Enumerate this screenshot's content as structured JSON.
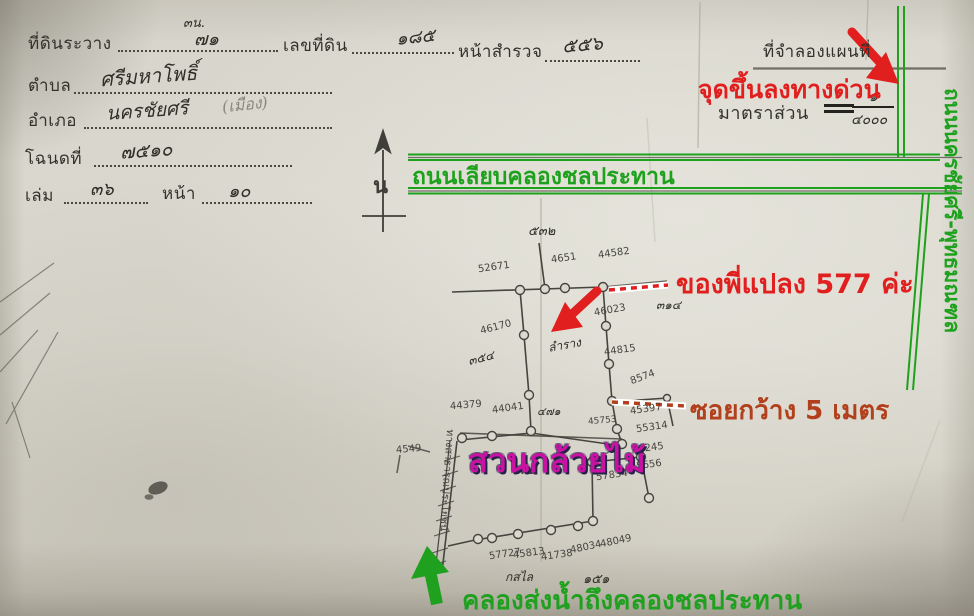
{
  "document": {
    "corner_note": "๓น.",
    "fields": {
      "sheet": {
        "label": "ที่ดินระวาง",
        "value": "๗๑"
      },
      "land_no": {
        "label": "เลขที่ดิน",
        "value": "๑๘๕"
      },
      "survey": {
        "label": "หน้าสำรวจ",
        "value": "๕๕๖"
      },
      "tambon": {
        "label": "ตำบล",
        "value": "ศรีมหาโพธิ์"
      },
      "amphoe": {
        "label": "อำเภอ",
        "value": "นครชัยศรี",
        "note": "(เมือง)"
      },
      "deed": {
        "label": "โฉนดที่",
        "value": "๗๕๑๐"
      },
      "book": {
        "label": "เล่ม",
        "value": "๓๖"
      },
      "page": {
        "label": "หน้า",
        "value": "๑๐"
      }
    },
    "map_title": "ที่จำลองแผนที่",
    "scale": {
      "label": "มาตราส่วน",
      "numerator": "๑",
      "denominator": "๔๐๐๐",
      "value": "๑/๔๐๐๐"
    },
    "north_symbol": "น"
  },
  "annotations": {
    "expressway_point": {
      "text": "จุดขึ้นลงทางด่วน",
      "color": "#e11f1f"
    },
    "canal_road": {
      "text": "ถนนเลียบคลองชลประทาน",
      "color": "#1ea21e"
    },
    "side_road": {
      "text": "ถนนนครชัยศรี-พุทธมณฑล",
      "color": "#1ea21e"
    },
    "plot_callout": {
      "text": "ของพี่แปลง 577 ค่ะ",
      "color": "#e11f1f"
    },
    "soi_width": {
      "text": "ซอยกว้าง 5 เมตร",
      "color": "#b2401c"
    },
    "orchid_farm": {
      "text": "สวนกล้วยไม้",
      "color": "#c712a2"
    },
    "water_canal": {
      "text": "คลองส่งน้ำถึงคลองชลประทาน",
      "color": "#1fa01f"
    }
  },
  "map": {
    "path_label": "ทางสาธารณประโยชน์",
    "parcel_numbers": [
      "52671",
      "4651",
      "44582",
      "46023",
      "46170",
      "44815",
      "8574",
      "44379",
      "44041",
      "45397",
      "45753",
      "55314",
      "45245",
      "4549",
      "45656",
      "57834",
      "57727",
      "45813",
      "41738",
      "48034",
      "48049"
    ],
    "notes": [
      "๕๓๒",
      "๓๑๔",
      "ลำราง",
      "๓๕๔",
      "๔๗๑",
      "๕๓๑",
      "๑๕๑",
      "กสไล"
    ]
  },
  "colors": {
    "paper": "#d7d5cb",
    "pencil": "#45443e",
    "annotation_green": "#1ea21e",
    "annotation_red": "#e11f1f",
    "annotation_dark_red": "#b2401c",
    "annotation_magenta": "#c712a2"
  }
}
